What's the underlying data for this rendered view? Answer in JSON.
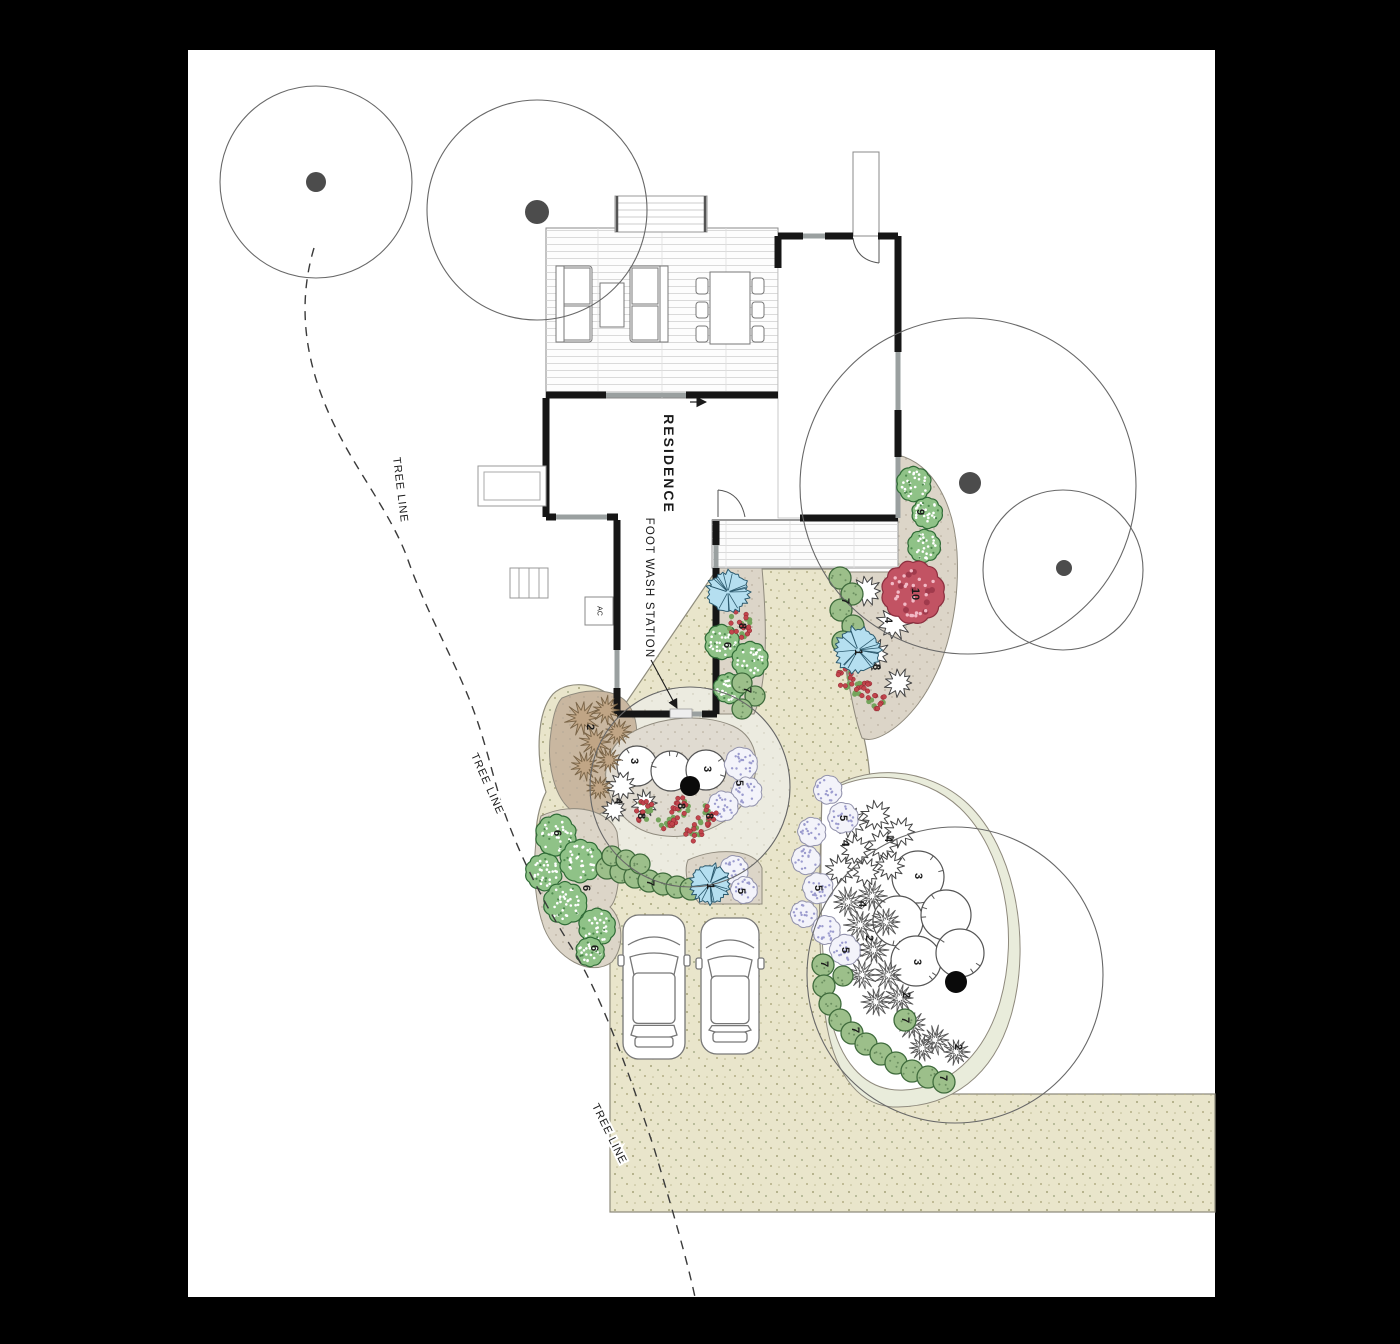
{
  "sheet": {
    "background": "#ffffff",
    "frame": "#000000"
  },
  "labels": {
    "residence": "RESIDENCE",
    "foot_wash_station": "FOOT WASH STATION",
    "tree_line": "TREE LINE",
    "ac_unit": "AC"
  },
  "tree_line_labels": [
    {
      "x": 400,
      "y": 490,
      "angle": 83
    },
    {
      "x": 487,
      "y": 784,
      "angle": 66
    },
    {
      "x": 609,
      "y": 1134,
      "angle": 64
    }
  ],
  "colors": {
    "driveway": "#e9e5cb",
    "driveway_speckle": "#a6a37b",
    "bed_taupe": "#dcd5c8",
    "bed_brown": "#c9b7a0",
    "bed_kidney": "#e0dbd1",
    "patio_pale": "#ecebe0",
    "pale_band": "#e9ecdb",
    "bed_white": "#ffffff",
    "shrub_green_fill": "#8fc287",
    "shrub_green_stroke": "#2f6b36",
    "circle_green_fill": "#9cbf8a",
    "circle_green_stroke": "#3f6b3c",
    "lavender_fill": "#f3f3fa",
    "lavender_stroke": "#9292ac",
    "lavender_dot": "#9b9bce",
    "palm_fill": "#b5dff0",
    "palm_stroke": "#2c5a6e",
    "red_shrub_fill": "#c25363",
    "red_shrub_stroke": "#8c2f3f",
    "red_shrub_dot": "#f2bac6",
    "berry_fill": "#c2444c",
    "berry_stroke": "#8c2830",
    "berry_leaf": "#74a45c",
    "grass_brown_fill": "#c0a585",
    "grass_brown_stroke": "#7a6548",
    "grass_white_stroke": "#555555",
    "wall": "#161616",
    "window": "#9aa0a0",
    "canopy_line": "#686868",
    "trunk_existing": "#4c4c4c",
    "trunk_proposed": "#0a0a0a",
    "text": "#1a1a1a"
  },
  "trees": {
    "existing": [
      {
        "cx": 316,
        "cy": 182,
        "r": 96,
        "tx": 316,
        "ty": 182,
        "tr": 10
      },
      {
        "cx": 537,
        "cy": 210,
        "r": 110,
        "tx": 537,
        "ty": 212,
        "tr": 12
      },
      {
        "cx": 968,
        "cy": 486,
        "r": 168,
        "tx": 970,
        "ty": 483,
        "tr": 11
      },
      {
        "cx": 1063,
        "cy": 570,
        "r": 80,
        "tx": 1064,
        "ty": 568,
        "tr": 8
      }
    ],
    "proposed": [
      {
        "cx": 690,
        "cy": 787,
        "r": 100,
        "tx": 690,
        "ty": 786,
        "tr": 10
      },
      {
        "cx": 955,
        "cy": 975,
        "r": 148,
        "tx": 956,
        "ty": 982,
        "tr": 11
      }
    ]
  },
  "plants": [
    {
      "t": "shrubW",
      "x": 637,
      "y": 766,
      "r": 20
    },
    {
      "t": "shrubW",
      "x": 671,
      "y": 771,
      "r": 20
    },
    {
      "t": "shrubW",
      "x": 706,
      "y": 770,
      "r": 20
    },
    {
      "t": "shrubW",
      "x": 918,
      "y": 877,
      "r": 26
    },
    {
      "t": "shrubW",
      "x": 898,
      "y": 921,
      "r": 25
    },
    {
      "t": "shrubW",
      "x": 946,
      "y": 915,
      "r": 25
    },
    {
      "t": "shrubW",
      "x": 916,
      "y": 961,
      "r": 25
    },
    {
      "t": "shrubW",
      "x": 960,
      "y": 953,
      "r": 24
    },
    {
      "t": "star",
      "x": 866,
      "y": 591,
      "r": 16
    },
    {
      "t": "star",
      "x": 894,
      "y": 623,
      "r": 17
    },
    {
      "t": "star",
      "x": 874,
      "y": 654,
      "r": 15
    },
    {
      "t": "star",
      "x": 899,
      "y": 683,
      "r": 14
    },
    {
      "t": "star",
      "x": 622,
      "y": 786,
      "r": 15
    },
    {
      "t": "star",
      "x": 645,
      "y": 803,
      "r": 13
    },
    {
      "t": "star",
      "x": 614,
      "y": 810,
      "r": 12
    },
    {
      "t": "star",
      "x": 850,
      "y": 822,
      "r": 16
    },
    {
      "t": "star",
      "x": 876,
      "y": 816,
      "r": 15
    },
    {
      "t": "star",
      "x": 900,
      "y": 832,
      "r": 15
    },
    {
      "t": "star",
      "x": 856,
      "y": 850,
      "r": 15
    },
    {
      "t": "star",
      "x": 882,
      "y": 845,
      "r": 15
    },
    {
      "t": "star",
      "x": 840,
      "y": 870,
      "r": 14
    },
    {
      "t": "star",
      "x": 866,
      "y": 872,
      "r": 14
    },
    {
      "t": "star",
      "x": 890,
      "y": 866,
      "r": 14
    },
    {
      "t": "grassB",
      "x": 582,
      "y": 718,
      "r": 17
    },
    {
      "t": "grassB",
      "x": 606,
      "y": 710,
      "r": 14
    },
    {
      "t": "grassB",
      "x": 595,
      "y": 742,
      "r": 15
    },
    {
      "t": "grassB",
      "x": 618,
      "y": 732,
      "r": 13
    },
    {
      "t": "grassB",
      "x": 585,
      "y": 766,
      "r": 14
    },
    {
      "t": "grassB",
      "x": 609,
      "y": 760,
      "r": 12
    },
    {
      "t": "grassB",
      "x": 599,
      "y": 788,
      "r": 12
    },
    {
      "t": "grassW",
      "x": 848,
      "y": 902,
      "r": 15
    },
    {
      "t": "grassW",
      "x": 872,
      "y": 896,
      "r": 14
    },
    {
      "t": "grassW",
      "x": 860,
      "y": 925,
      "r": 15
    },
    {
      "t": "grassW",
      "x": 886,
      "y": 922,
      "r": 14
    },
    {
      "t": "grassW",
      "x": 850,
      "y": 950,
      "r": 15
    },
    {
      "t": "grassW",
      "x": 874,
      "y": 950,
      "r": 14
    },
    {
      "t": "grassW",
      "x": 862,
      "y": 975,
      "r": 14
    },
    {
      "t": "grassW",
      "x": 888,
      "y": 975,
      "r": 14
    },
    {
      "t": "grassW",
      "x": 900,
      "y": 998,
      "r": 14
    },
    {
      "t": "grassW",
      "x": 876,
      "y": 1002,
      "r": 14
    },
    {
      "t": "grassW",
      "x": 912,
      "y": 1025,
      "r": 14
    },
    {
      "t": "grassW",
      "x": 935,
      "y": 1040,
      "r": 14
    },
    {
      "t": "grassW",
      "x": 956,
      "y": 1052,
      "r": 13
    },
    {
      "t": "grassW",
      "x": 922,
      "y": 1048,
      "r": 13
    },
    {
      "t": "shrubG",
      "x": 722,
      "y": 642,
      "r": 17
    },
    {
      "t": "shrubG",
      "x": 750,
      "y": 660,
      "r": 18
    },
    {
      "t": "shrubG",
      "x": 729,
      "y": 688,
      "r": 15
    },
    {
      "t": "shrubG",
      "x": 556,
      "y": 835,
      "r": 20
    },
    {
      "t": "shrubG",
      "x": 544,
      "y": 872,
      "r": 18
    },
    {
      "t": "shrubG",
      "x": 581,
      "y": 861,
      "r": 21
    },
    {
      "t": "shrubG",
      "x": 565,
      "y": 903,
      "r": 21
    },
    {
      "t": "shrubG",
      "x": 597,
      "y": 927,
      "r": 18
    },
    {
      "t": "shrubG",
      "x": 590,
      "y": 952,
      "r": 14
    },
    {
      "t": "shrubG",
      "x": 914,
      "y": 484,
      "r": 17
    },
    {
      "t": "shrubG",
      "x": 927,
      "y": 513,
      "r": 15
    },
    {
      "t": "shrubG",
      "x": 924,
      "y": 546,
      "r": 16
    },
    {
      "t": "lav",
      "x": 741,
      "y": 764,
      "r": 16
    },
    {
      "t": "lav",
      "x": 747,
      "y": 792,
      "r": 15
    },
    {
      "t": "lav",
      "x": 723,
      "y": 806,
      "r": 15
    },
    {
      "t": "lav",
      "x": 734,
      "y": 870,
      "r": 14
    },
    {
      "t": "lav",
      "x": 744,
      "y": 890,
      "r": 13
    },
    {
      "t": "lav",
      "x": 828,
      "y": 790,
      "r": 14
    },
    {
      "t": "lav",
      "x": 843,
      "y": 818,
      "r": 15
    },
    {
      "t": "lav",
      "x": 812,
      "y": 832,
      "r": 14
    },
    {
      "t": "lav",
      "x": 806,
      "y": 860,
      "r": 14
    },
    {
      "t": "lav",
      "x": 818,
      "y": 888,
      "r": 15
    },
    {
      "t": "lav",
      "x": 804,
      "y": 914,
      "r": 13
    },
    {
      "t": "lav",
      "x": 826,
      "y": 930,
      "r": 14
    },
    {
      "t": "lav",
      "x": 845,
      "y": 950,
      "r": 15
    },
    {
      "t": "circle7",
      "x": 742,
      "y": 683,
      "r": 10
    },
    {
      "t": "circle7",
      "x": 755,
      "y": 696,
      "r": 10
    },
    {
      "t": "circle7",
      "x": 742,
      "y": 709,
      "r": 10
    },
    {
      "t": "circle7",
      "x": 840,
      "y": 578,
      "r": 11
    },
    {
      "t": "circle7",
      "x": 852,
      "y": 594,
      "r": 11
    },
    {
      "t": "circle7",
      "x": 841,
      "y": 610,
      "r": 11
    },
    {
      "t": "circle7",
      "x": 853,
      "y": 626,
      "r": 11
    },
    {
      "t": "circle7",
      "x": 843,
      "y": 642,
      "r": 11
    },
    {
      "t": "circle7",
      "x": 607,
      "y": 868,
      "r": 11
    },
    {
      "t": "circle7",
      "x": 621,
      "y": 872,
      "r": 11
    },
    {
      "t": "circle7",
      "x": 635,
      "y": 877,
      "r": 11
    },
    {
      "t": "circle7",
      "x": 649,
      "y": 881,
      "r": 11
    },
    {
      "t": "circle7",
      "x": 663,
      "y": 884,
      "r": 11
    },
    {
      "t": "circle7",
      "x": 677,
      "y": 887,
      "r": 11
    },
    {
      "t": "circle7",
      "x": 691,
      "y": 889,
      "r": 11
    },
    {
      "t": "circle7",
      "x": 612,
      "y": 856,
      "r": 10
    },
    {
      "t": "circle7",
      "x": 626,
      "y": 860,
      "r": 10
    },
    {
      "t": "circle7",
      "x": 640,
      "y": 864,
      "r": 10
    },
    {
      "t": "circle7",
      "x": 823,
      "y": 965,
      "r": 11
    },
    {
      "t": "circle7",
      "x": 824,
      "y": 986,
      "r": 11
    },
    {
      "t": "circle7",
      "x": 830,
      "y": 1004,
      "r": 11
    },
    {
      "t": "circle7",
      "x": 840,
      "y": 1020,
      "r": 11
    },
    {
      "t": "circle7",
      "x": 852,
      "y": 1033,
      "r": 11
    },
    {
      "t": "circle7",
      "x": 866,
      "y": 1044,
      "r": 11
    },
    {
      "t": "circle7",
      "x": 881,
      "y": 1054,
      "r": 11
    },
    {
      "t": "circle7",
      "x": 896,
      "y": 1063,
      "r": 11
    },
    {
      "t": "circle7",
      "x": 912,
      "y": 1071,
      "r": 11
    },
    {
      "t": "circle7",
      "x": 928,
      "y": 1077,
      "r": 11
    },
    {
      "t": "circle7",
      "x": 944,
      "y": 1082,
      "r": 11
    },
    {
      "t": "circle7",
      "x": 905,
      "y": 1020,
      "r": 11
    },
    {
      "t": "circle7",
      "x": 843,
      "y": 976,
      "r": 10
    },
    {
      "t": "berry",
      "x": 740,
      "y": 624,
      "r": 18
    },
    {
      "t": "berry",
      "x": 643,
      "y": 812,
      "r": 14
    },
    {
      "t": "berry",
      "x": 668,
      "y": 822,
      "r": 13
    },
    {
      "t": "berry",
      "x": 683,
      "y": 806,
      "r": 12
    },
    {
      "t": "berry",
      "x": 707,
      "y": 815,
      "r": 13
    },
    {
      "t": "berry",
      "x": 693,
      "y": 832,
      "r": 11
    },
    {
      "t": "berry",
      "x": 845,
      "y": 678,
      "r": 12
    },
    {
      "t": "berry",
      "x": 862,
      "y": 690,
      "r": 12
    },
    {
      "t": "berry",
      "x": 876,
      "y": 700,
      "r": 11
    },
    {
      "t": "palm",
      "x": 728,
      "y": 592,
      "r": 21
    },
    {
      "t": "palm",
      "x": 858,
      "y": 650,
      "r": 23
    },
    {
      "t": "palm",
      "x": 710,
      "y": 884,
      "r": 20
    },
    {
      "t": "red10",
      "x": 913,
      "y": 592,
      "r": 30
    }
  ],
  "plant_labels": [
    {
      "n": "1",
      "x": 858,
      "y": 652
    },
    {
      "n": "1",
      "x": 710,
      "y": 886
    },
    {
      "n": "2",
      "x": 590,
      "y": 727
    },
    {
      "n": "2",
      "x": 869,
      "y": 938
    },
    {
      "n": "2",
      "x": 906,
      "y": 995
    },
    {
      "n": "2",
      "x": 958,
      "y": 1047
    },
    {
      "n": "3",
      "x": 634,
      "y": 761
    },
    {
      "n": "3",
      "x": 707,
      "y": 769
    },
    {
      "n": "3",
      "x": 918,
      "y": 876
    },
    {
      "n": "3",
      "x": 917,
      "y": 962
    },
    {
      "n": "4",
      "x": 888,
      "y": 620
    },
    {
      "n": "4",
      "x": 618,
      "y": 801
    },
    {
      "n": "4",
      "x": 845,
      "y": 843
    },
    {
      "n": "4",
      "x": 888,
      "y": 839
    },
    {
      "n": "4",
      "x": 862,
      "y": 904
    },
    {
      "n": "5",
      "x": 739,
      "y": 783
    },
    {
      "n": "5",
      "x": 741,
      "y": 891
    },
    {
      "n": "5",
      "x": 843,
      "y": 818
    },
    {
      "n": "5",
      "x": 818,
      "y": 888
    },
    {
      "n": "5",
      "x": 845,
      "y": 950
    },
    {
      "n": "6",
      "x": 727,
      "y": 645
    },
    {
      "n": "6",
      "x": 557,
      "y": 833
    },
    {
      "n": "6",
      "x": 586,
      "y": 888
    },
    {
      "n": "6",
      "x": 594,
      "y": 948
    },
    {
      "n": "7",
      "x": 747,
      "y": 690
    },
    {
      "n": "7",
      "x": 845,
      "y": 601
    },
    {
      "n": "7",
      "x": 650,
      "y": 883
    },
    {
      "n": "7",
      "x": 824,
      "y": 964
    },
    {
      "n": "7",
      "x": 855,
      "y": 1030
    },
    {
      "n": "7",
      "x": 905,
      "y": 1020
    },
    {
      "n": "7",
      "x": 943,
      "y": 1078
    },
    {
      "n": "8",
      "x": 742,
      "y": 626
    },
    {
      "n": "8",
      "x": 641,
      "y": 816
    },
    {
      "n": "8",
      "x": 681,
      "y": 806
    },
    {
      "n": "8",
      "x": 709,
      "y": 816
    },
    {
      "n": "8",
      "x": 876,
      "y": 667
    },
    {
      "n": "9",
      "x": 920,
      "y": 512
    },
    {
      "n": "10",
      "x": 915,
      "y": 594
    }
  ]
}
